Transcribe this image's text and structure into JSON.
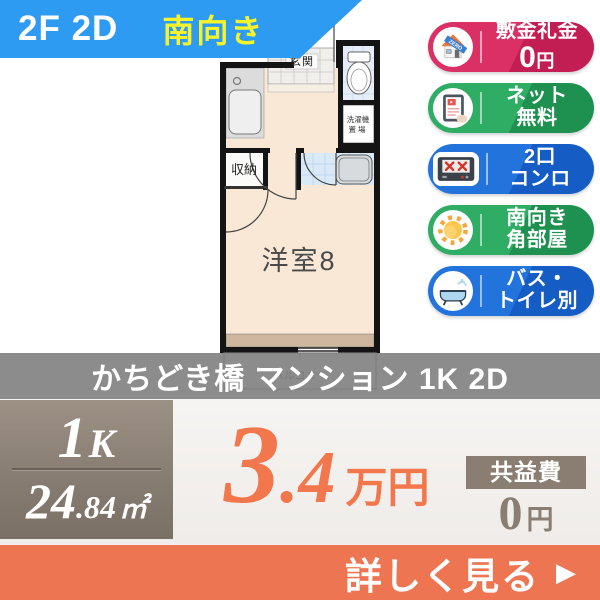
{
  "ribbon": {
    "floor_unit": "2F 2D",
    "facing": "南向き"
  },
  "floorplan": {
    "entrance": "玄関",
    "storage": "収納",
    "room": "洋室8",
    "laundry_line1": "洗濯機",
    "laundry_line2": "置場",
    "balcony": "バルコニー"
  },
  "badges": [
    {
      "name": "敷金礼金0円",
      "line1": "敷金礼金",
      "zero": "0",
      "yen": "円",
      "icon": "house-zero-icon",
      "color": "#D62A5F"
    },
    {
      "name": "ネット無料",
      "line1": "ネット",
      "line2": "無料",
      "icon": "tablet-icon",
      "color": "#2BA65F"
    },
    {
      "name": "2口コンロ",
      "line1": "2口",
      "line2": "コンロ",
      "icon": "stove-icon",
      "color": "#1E70D8"
    },
    {
      "name": "南向き角部屋",
      "line1": "南向き",
      "line2": "角部屋",
      "icon": "sun-icon",
      "color": "#2BA65F"
    },
    {
      "name": "バス・トイレ別",
      "line1": "バス・",
      "line2": "トイレ別",
      "icon": "bathtub-icon",
      "color": "#1E70D8"
    }
  ],
  "title": "かちどき橋 マンション 1K 2D",
  "spec": {
    "layout_num": "1",
    "layout_letter": "K",
    "area_int": "24",
    "area_dec": ".84",
    "area_unit": "㎡"
  },
  "price": {
    "int": "3",
    "dec": ".4",
    "unit": "万円"
  },
  "fee": {
    "label": "共益費",
    "value": "0",
    "unit": "円"
  },
  "cta": {
    "label": "詳しく見る",
    "arrow": "▶"
  },
  "colors": {
    "ribbon_blue": "#2E9BF2",
    "facing_yellow": "#F7F32B",
    "badge_red": "#D62A5F",
    "badge_green": "#2BA65F",
    "badge_blue": "#1E70D8",
    "price_orange": "#F3774C",
    "taupe": "#8A7D71",
    "cta_orange": "#EE7552",
    "floor_cream": "#F9E8D6",
    "bath_blue": "#D9E9F7"
  }
}
